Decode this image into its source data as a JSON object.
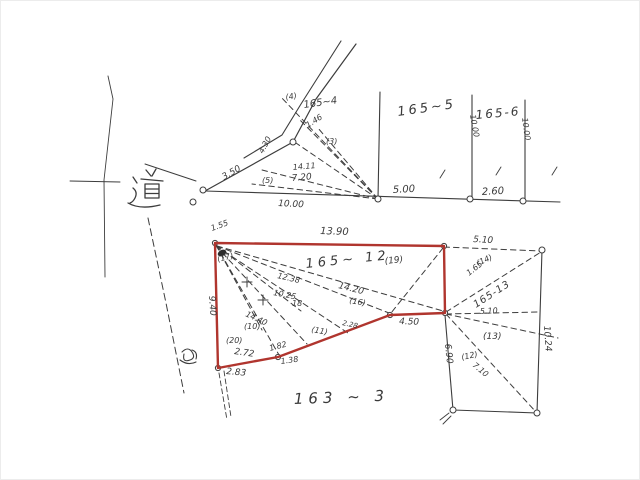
{
  "page": {
    "background": "#ffffff",
    "ink_color": "#3d3d3d",
    "highlight_color": "#b0352e"
  },
  "parcel_labels": {
    "p165_4": "165~4",
    "p165_5": "165~5",
    "p165_6": "165-6",
    "p165_12": "165~ 12",
    "p165_12_pt": "(19)",
    "p165_13": "165-13",
    "p163_3": "163 ~ 3",
    "road": "道"
  },
  "measurements": {
    "pt4": "(4)",
    "base_10": "10.00",
    "base_5": "5.00",
    "base_2_6": "2.60",
    "v_left": "10.00",
    "v_right": "10.00",
    "top_left_diag": "3.50",
    "fan_4_30": "4.30",
    "fan_1_46": "1.46",
    "pt3": "(3)",
    "fan_14_11": "14.11",
    "fan_7_20": "7.20",
    "pt5": "(5)",
    "red_1_55": "1.55",
    "red_top": "13.90",
    "red_diag_14_20": "14.20",
    "red_left": "9.40",
    "pt16": "(16)",
    "pt17": "(17)",
    "in_12_38": "12.38",
    "in_10_25": "10.25",
    "in_18": "18",
    "in_14_40": "14.40",
    "pt10": "(10)",
    "pt11": "(11)",
    "b_2_28": "2.28",
    "r_4_50": "4.50",
    "pt20": "(20)",
    "b_2_72": "2.72",
    "b_1_82": "1.82",
    "b_1_38": "1.38",
    "b_2_83": "2.83",
    "r13_top": "5.10",
    "pt14": "(14)",
    "r13_1_65": "1.65",
    "r13_mid": "5.10",
    "pt13": "(13)",
    "r13_right_v": "10.24",
    "r13_left_v": "6.90",
    "pt12": "(12)",
    "r13_7_10": "7.10"
  }
}
